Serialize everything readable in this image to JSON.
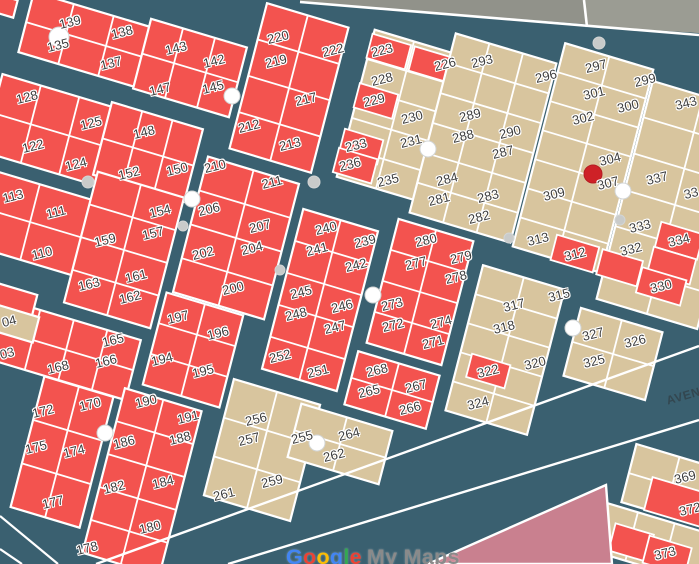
{
  "street_label": "AVEN",
  "watermark": {
    "brand_letters": [
      {
        "ch": "G",
        "color": "#4285F4"
      },
      {
        "ch": "o",
        "color": "#EA4335"
      },
      {
        "ch": "o",
        "color": "#FBBC05"
      },
      {
        "ch": "g",
        "color": "#4285F4"
      },
      {
        "ch": "l",
        "color": "#34A853"
      },
      {
        "ch": "e",
        "color": "#EA4335"
      }
    ],
    "product": "My Maps",
    "product_color": "#8a8a8a"
  },
  "palette": {
    "street": "#3a6070",
    "parcel_red": "#f3534f",
    "parcel_tan": "#d8c59e",
    "outside_gray": "#91928a",
    "outside_gray_right": "#9b9c93",
    "pink_parcel": "#c9808f",
    "border_line": "#ffffff",
    "marker_white": "#ffffff",
    "marker_gray": "#c9cbca",
    "marker_red": "#ce2127",
    "label_text": "#3e3e3e"
  },
  "parcel_labels": [
    {
      "t": "139",
      "x": 70,
      "y": 22
    },
    {
      "t": "135",
      "x": 58,
      "y": 45
    },
    {
      "t": "138",
      "x": 122,
      "y": 32
    },
    {
      "t": "137",
      "x": 111,
      "y": 63
    },
    {
      "t": "143",
      "x": 176,
      "y": 48
    },
    {
      "t": "142",
      "x": 214,
      "y": 61
    },
    {
      "t": "147",
      "x": 160,
      "y": 89
    },
    {
      "t": "145",
      "x": 213,
      "y": 87
    },
    {
      "t": "128",
      "x": 27,
      "y": 97
    },
    {
      "t": "125",
      "x": 91,
      "y": 123
    },
    {
      "t": "122",
      "x": 33,
      "y": 146
    },
    {
      "t": "124",
      "x": 76,
      "y": 164
    },
    {
      "t": "148",
      "x": 144,
      "y": 132
    },
    {
      "t": "152",
      "x": 129,
      "y": 173
    },
    {
      "t": "150",
      "x": 177,
      "y": 169
    },
    {
      "t": "113",
      "x": 13,
      "y": 196
    },
    {
      "t": "111",
      "x": 56,
      "y": 212
    },
    {
      "t": "110",
      "x": 42,
      "y": 253
    },
    {
      "t": "210",
      "x": 215,
      "y": 166
    },
    {
      "t": "211",
      "x": 272,
      "y": 182
    },
    {
      "t": "206",
      "x": 209,
      "y": 209
    },
    {
      "t": "207",
      "x": 260,
      "y": 226
    },
    {
      "t": "202",
      "x": 203,
      "y": 253
    },
    {
      "t": "204",
      "x": 252,
      "y": 248
    },
    {
      "t": "200",
      "x": 233,
      "y": 288
    },
    {
      "t": "154",
      "x": 160,
      "y": 211
    },
    {
      "t": "157",
      "x": 153,
      "y": 233
    },
    {
      "t": "159",
      "x": 105,
      "y": 240
    },
    {
      "t": "161",
      "x": 136,
      "y": 276
    },
    {
      "t": "162",
      "x": 130,
      "y": 297
    },
    {
      "t": "163",
      "x": 89,
      "y": 284
    },
    {
      "t": "165",
      "x": 113,
      "y": 340
    },
    {
      "t": "166",
      "x": 106,
      "y": 361
    },
    {
      "t": "168",
      "x": 58,
      "y": 367
    },
    {
      "t": "04",
      "x": 9,
      "y": 321
    },
    {
      "t": "03",
      "x": 7,
      "y": 353
    },
    {
      "t": "197",
      "x": 178,
      "y": 317
    },
    {
      "t": "196",
      "x": 218,
      "y": 333
    },
    {
      "t": "194",
      "x": 162,
      "y": 359
    },
    {
      "t": "195",
      "x": 203,
      "y": 371
    },
    {
      "t": "172",
      "x": 43,
      "y": 411
    },
    {
      "t": "170",
      "x": 90,
      "y": 404
    },
    {
      "t": "175",
      "x": 36,
      "y": 447
    },
    {
      "t": "174",
      "x": 74,
      "y": 451
    },
    {
      "t": "177",
      "x": 53,
      "y": 502
    },
    {
      "t": "190",
      "x": 146,
      "y": 401
    },
    {
      "t": "191",
      "x": 188,
      "y": 417
    },
    {
      "t": "186",
      "x": 124,
      "y": 442
    },
    {
      "t": "188",
      "x": 180,
      "y": 438
    },
    {
      "t": "182",
      "x": 114,
      "y": 487
    },
    {
      "t": "184",
      "x": 163,
      "y": 482
    },
    {
      "t": "180",
      "x": 150,
      "y": 527
    },
    {
      "t": "178",
      "x": 87,
      "y": 548
    },
    {
      "t": "220",
      "x": 278,
      "y": 37
    },
    {
      "t": "222",
      "x": 333,
      "y": 50
    },
    {
      "t": "219",
      "x": 276,
      "y": 61
    },
    {
      "t": "217",
      "x": 306,
      "y": 99
    },
    {
      "t": "212",
      "x": 249,
      "y": 126
    },
    {
      "t": "213",
      "x": 290,
      "y": 144
    },
    {
      "t": "223",
      "x": 382,
      "y": 50
    },
    {
      "t": "226",
      "x": 445,
      "y": 64
    },
    {
      "t": "228",
      "x": 382,
      "y": 79
    },
    {
      "t": "229",
      "x": 374,
      "y": 100
    },
    {
      "t": "230",
      "x": 412,
      "y": 117
    },
    {
      "t": "231",
      "x": 411,
      "y": 141
    },
    {
      "t": "233",
      "x": 356,
      "y": 145
    },
    {
      "t": "236",
      "x": 350,
      "y": 164
    },
    {
      "t": "235",
      "x": 388,
      "y": 180
    },
    {
      "t": "240",
      "x": 326,
      "y": 228
    },
    {
      "t": "239",
      "x": 365,
      "y": 241
    },
    {
      "t": "241",
      "x": 317,
      "y": 249
    },
    {
      "t": "242",
      "x": 356,
      "y": 265
    },
    {
      "t": "245",
      "x": 301,
      "y": 292
    },
    {
      "t": "246",
      "x": 342,
      "y": 306
    },
    {
      "t": "248",
      "x": 296,
      "y": 314
    },
    {
      "t": "247",
      "x": 335,
      "y": 327
    },
    {
      "t": "252",
      "x": 280,
      "y": 356
    },
    {
      "t": "251",
      "x": 318,
      "y": 371
    },
    {
      "t": "280",
      "x": 426,
      "y": 240
    },
    {
      "t": "277",
      "x": 416,
      "y": 263
    },
    {
      "t": "279",
      "x": 461,
      "y": 257
    },
    {
      "t": "278",
      "x": 456,
      "y": 277
    },
    {
      "t": "273",
      "x": 392,
      "y": 304
    },
    {
      "t": "272",
      "x": 393,
      "y": 325
    },
    {
      "t": "274",
      "x": 441,
      "y": 322
    },
    {
      "t": "271",
      "x": 433,
      "y": 342
    },
    {
      "t": "268",
      "x": 377,
      "y": 370
    },
    {
      "t": "265",
      "x": 369,
      "y": 391
    },
    {
      "t": "267",
      "x": 416,
      "y": 386
    },
    {
      "t": "266",
      "x": 410,
      "y": 408
    },
    {
      "t": "293",
      "x": 482,
      "y": 61
    },
    {
      "t": "296",
      "x": 546,
      "y": 76
    },
    {
      "t": "289",
      "x": 470,
      "y": 115
    },
    {
      "t": "288",
      "x": 463,
      "y": 136
    },
    {
      "t": "290",
      "x": 510,
      "y": 132
    },
    {
      "t": "287",
      "x": 503,
      "y": 152
    },
    {
      "t": "284",
      "x": 447,
      "y": 179
    },
    {
      "t": "281",
      "x": 439,
      "y": 199
    },
    {
      "t": "283",
      "x": 488,
      "y": 196
    },
    {
      "t": "282",
      "x": 479,
      "y": 217
    },
    {
      "t": "297",
      "x": 596,
      "y": 66
    },
    {
      "t": "299",
      "x": 645,
      "y": 80
    },
    {
      "t": "301",
      "x": 594,
      "y": 93
    },
    {
      "t": "300",
      "x": 628,
      "y": 106
    },
    {
      "t": "302",
      "x": 583,
      "y": 118
    },
    {
      "t": "304",
      "x": 610,
      "y": 159
    },
    {
      "t": "307",
      "x": 608,
      "y": 183
    },
    {
      "t": "309",
      "x": 554,
      "y": 194
    },
    {
      "t": "313",
      "x": 538,
      "y": 239
    },
    {
      "t": "312",
      "x": 575,
      "y": 254
    },
    {
      "t": "343",
      "x": 686,
      "y": 103
    },
    {
      "t": "337",
      "x": 657,
      "y": 178
    },
    {
      "t": "33",
      "x": 691,
      "y": 193
    },
    {
      "t": "333",
      "x": 640,
      "y": 226
    },
    {
      "t": "332",
      "x": 631,
      "y": 249
    },
    {
      "t": "334",
      "x": 679,
      "y": 240
    },
    {
      "t": "330",
      "x": 661,
      "y": 286
    },
    {
      "t": "315",
      "x": 559,
      "y": 295
    },
    {
      "t": "317",
      "x": 514,
      "y": 305
    },
    {
      "t": "318",
      "x": 504,
      "y": 327
    },
    {
      "t": "320",
      "x": 535,
      "y": 363
    },
    {
      "t": "322",
      "x": 488,
      "y": 371
    },
    {
      "t": "324",
      "x": 478,
      "y": 403
    },
    {
      "t": "327",
      "x": 593,
      "y": 334
    },
    {
      "t": "326",
      "x": 635,
      "y": 341
    },
    {
      "t": "325",
      "x": 594,
      "y": 361
    },
    {
      "t": "256",
      "x": 256,
      "y": 419
    },
    {
      "t": "257",
      "x": 249,
      "y": 439
    },
    {
      "t": "255",
      "x": 302,
      "y": 437
    },
    {
      "t": "259",
      "x": 272,
      "y": 481
    },
    {
      "t": "261",
      "x": 224,
      "y": 494
    },
    {
      "t": "264",
      "x": 349,
      "y": 434
    },
    {
      "t": "262",
      "x": 334,
      "y": 455
    },
    {
      "t": "369",
      "x": 685,
      "y": 477
    },
    {
      "t": "372",
      "x": 690,
      "y": 509
    },
    {
      "t": "373",
      "x": 665,
      "y": 553
    }
  ],
  "markers": [
    {
      "x": 59,
      "y": 37,
      "r": 10,
      "kind": "white"
    },
    {
      "x": 88,
      "y": 182,
      "r": 6,
      "kind": "gray"
    },
    {
      "x": 232,
      "y": 96,
      "r": 8,
      "kind": "white"
    },
    {
      "x": 314,
      "y": 182,
      "r": 6,
      "kind": "gray"
    },
    {
      "x": 428,
      "y": 149,
      "r": 8,
      "kind": "white"
    },
    {
      "x": 599,
      "y": 43,
      "r": 6,
      "kind": "gray"
    },
    {
      "x": 192,
      "y": 199,
      "r": 8,
      "kind": "white"
    },
    {
      "x": 183,
      "y": 226,
      "r": 5,
      "kind": "gray"
    },
    {
      "x": 280,
      "y": 270,
      "r": 5,
      "kind": "gray"
    },
    {
      "x": 373,
      "y": 295,
      "r": 8,
      "kind": "white"
    },
    {
      "x": 623,
      "y": 191,
      "r": 8,
      "kind": "white"
    },
    {
      "x": 620,
      "y": 220,
      "r": 5,
      "kind": "gray"
    },
    {
      "x": 509,
      "y": 238,
      "r": 5,
      "kind": "gray"
    },
    {
      "x": 573,
      "y": 328,
      "r": 8,
      "kind": "white"
    },
    {
      "x": 105,
      "y": 433,
      "r": 8,
      "kind": "white"
    },
    {
      "x": 317,
      "y": 443,
      "r": 8,
      "kind": "white"
    },
    {
      "x": 593,
      "y": 174,
      "r": 9,
      "kind": "red"
    }
  ]
}
